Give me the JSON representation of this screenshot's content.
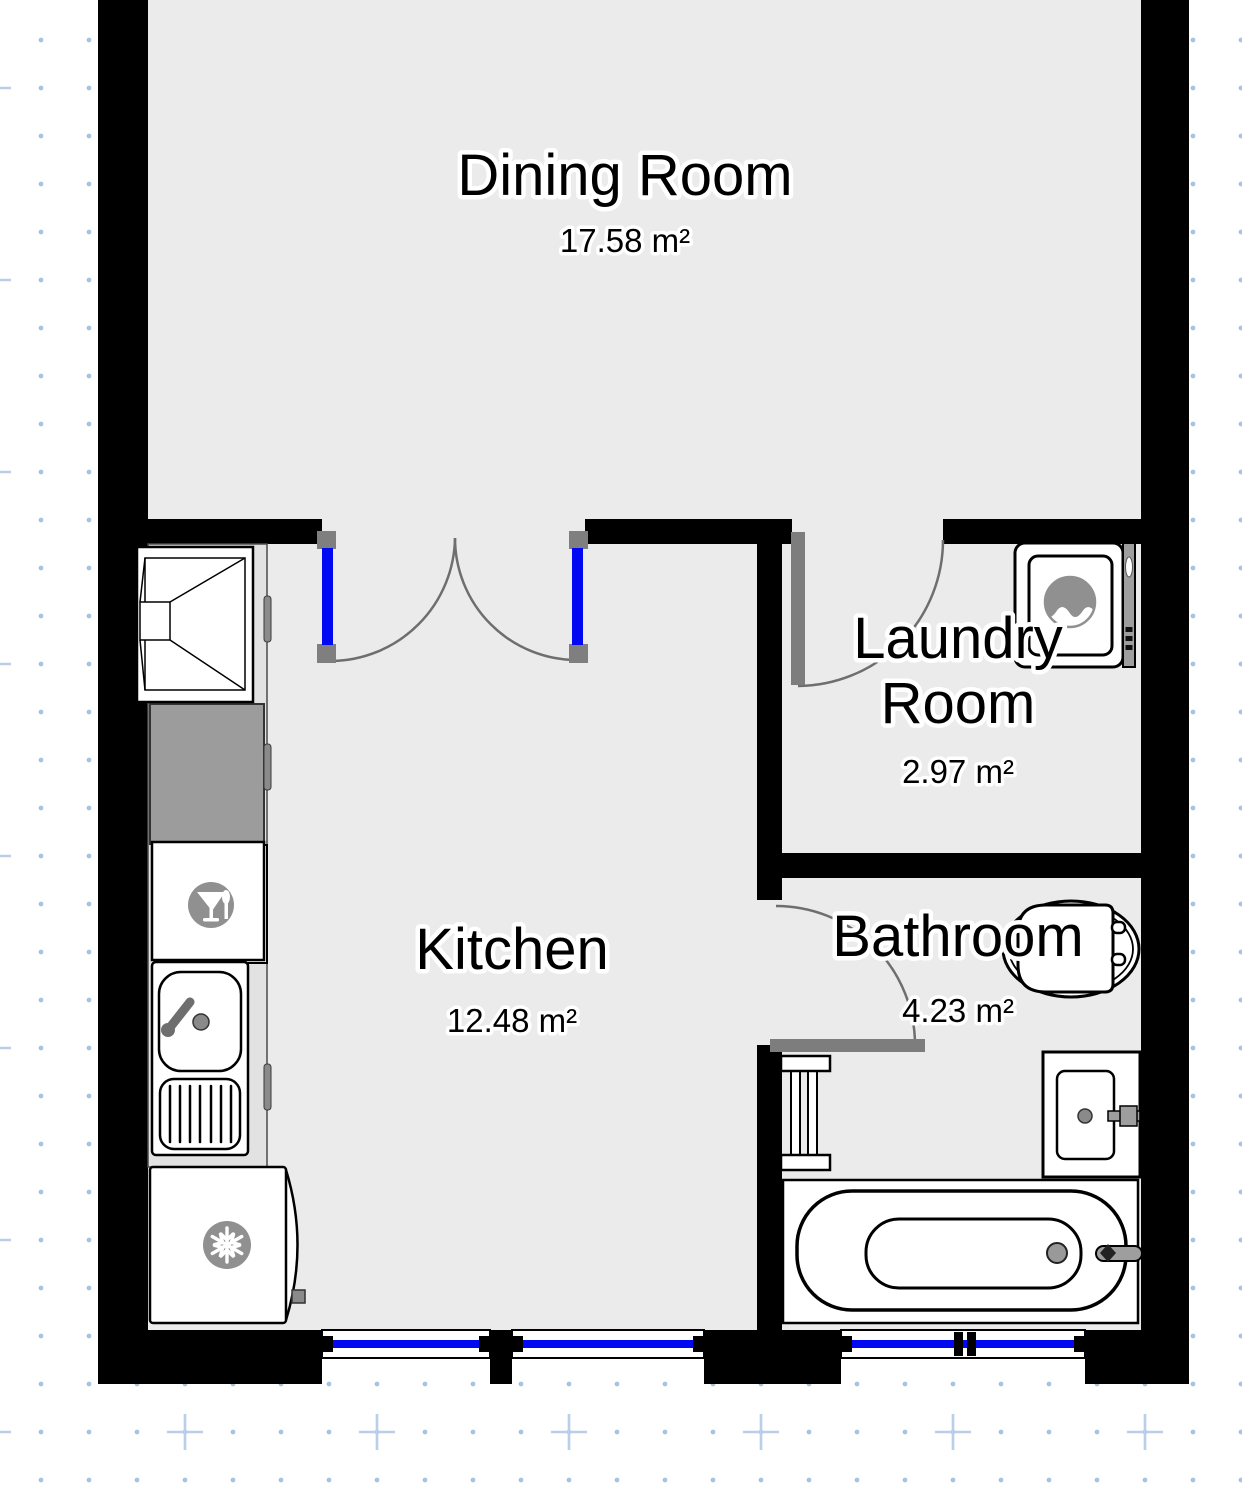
{
  "canvas": {
    "width": 1242,
    "height": 1485
  },
  "rooms": {
    "dining": {
      "name": "Dining Room",
      "area": "17.58 m²"
    },
    "laundry": {
      "name_line1": "Laundry",
      "name_line2": "Room",
      "area": "2.97 m²"
    },
    "kitchen": {
      "name": "Kitchen",
      "area": "12.48 m²"
    },
    "bathroom": {
      "name": "Bathroom",
      "area": "4.23 m²"
    }
  },
  "fixtures": {
    "kitchen": [
      "extractor-hood",
      "countertop",
      "dishwasher",
      "sink-with-drainboard",
      "refrigerator"
    ],
    "laundry": [
      "washing-machine"
    ],
    "bathroom": [
      "toilet",
      "towel-radiator",
      "washbasin",
      "bathtub"
    ]
  },
  "icons": {
    "dishwasher": "wine-glass-icon",
    "refrigerator": "snowflake-icon",
    "washing_machine": "water-wave-icon"
  },
  "doors": [
    "double-door-dining-kitchen",
    "door-dining-laundry",
    "door-kitchen-bathroom"
  ],
  "windows": [
    "kitchen-window-left",
    "kitchen-window-right",
    "bathroom-window"
  ],
  "colors": {
    "wall": "#000000",
    "floor": "#ebebeb",
    "counter": "#e2e2e2",
    "counter-dark": "#9c9c9c",
    "outline": "#000000",
    "fixture-gray": "#909090",
    "hardware-gray": "#8a8a8a",
    "door-leaf": "#7d7d7d",
    "door-cap": "#7f7f7f",
    "arc": "#6e6e6e",
    "window-blue": "#0009f2",
    "grid-dot": "#a9c3e1",
    "grid-plus": "#b9cfe9",
    "halo": "#ffffff",
    "text": "#000000"
  }
}
